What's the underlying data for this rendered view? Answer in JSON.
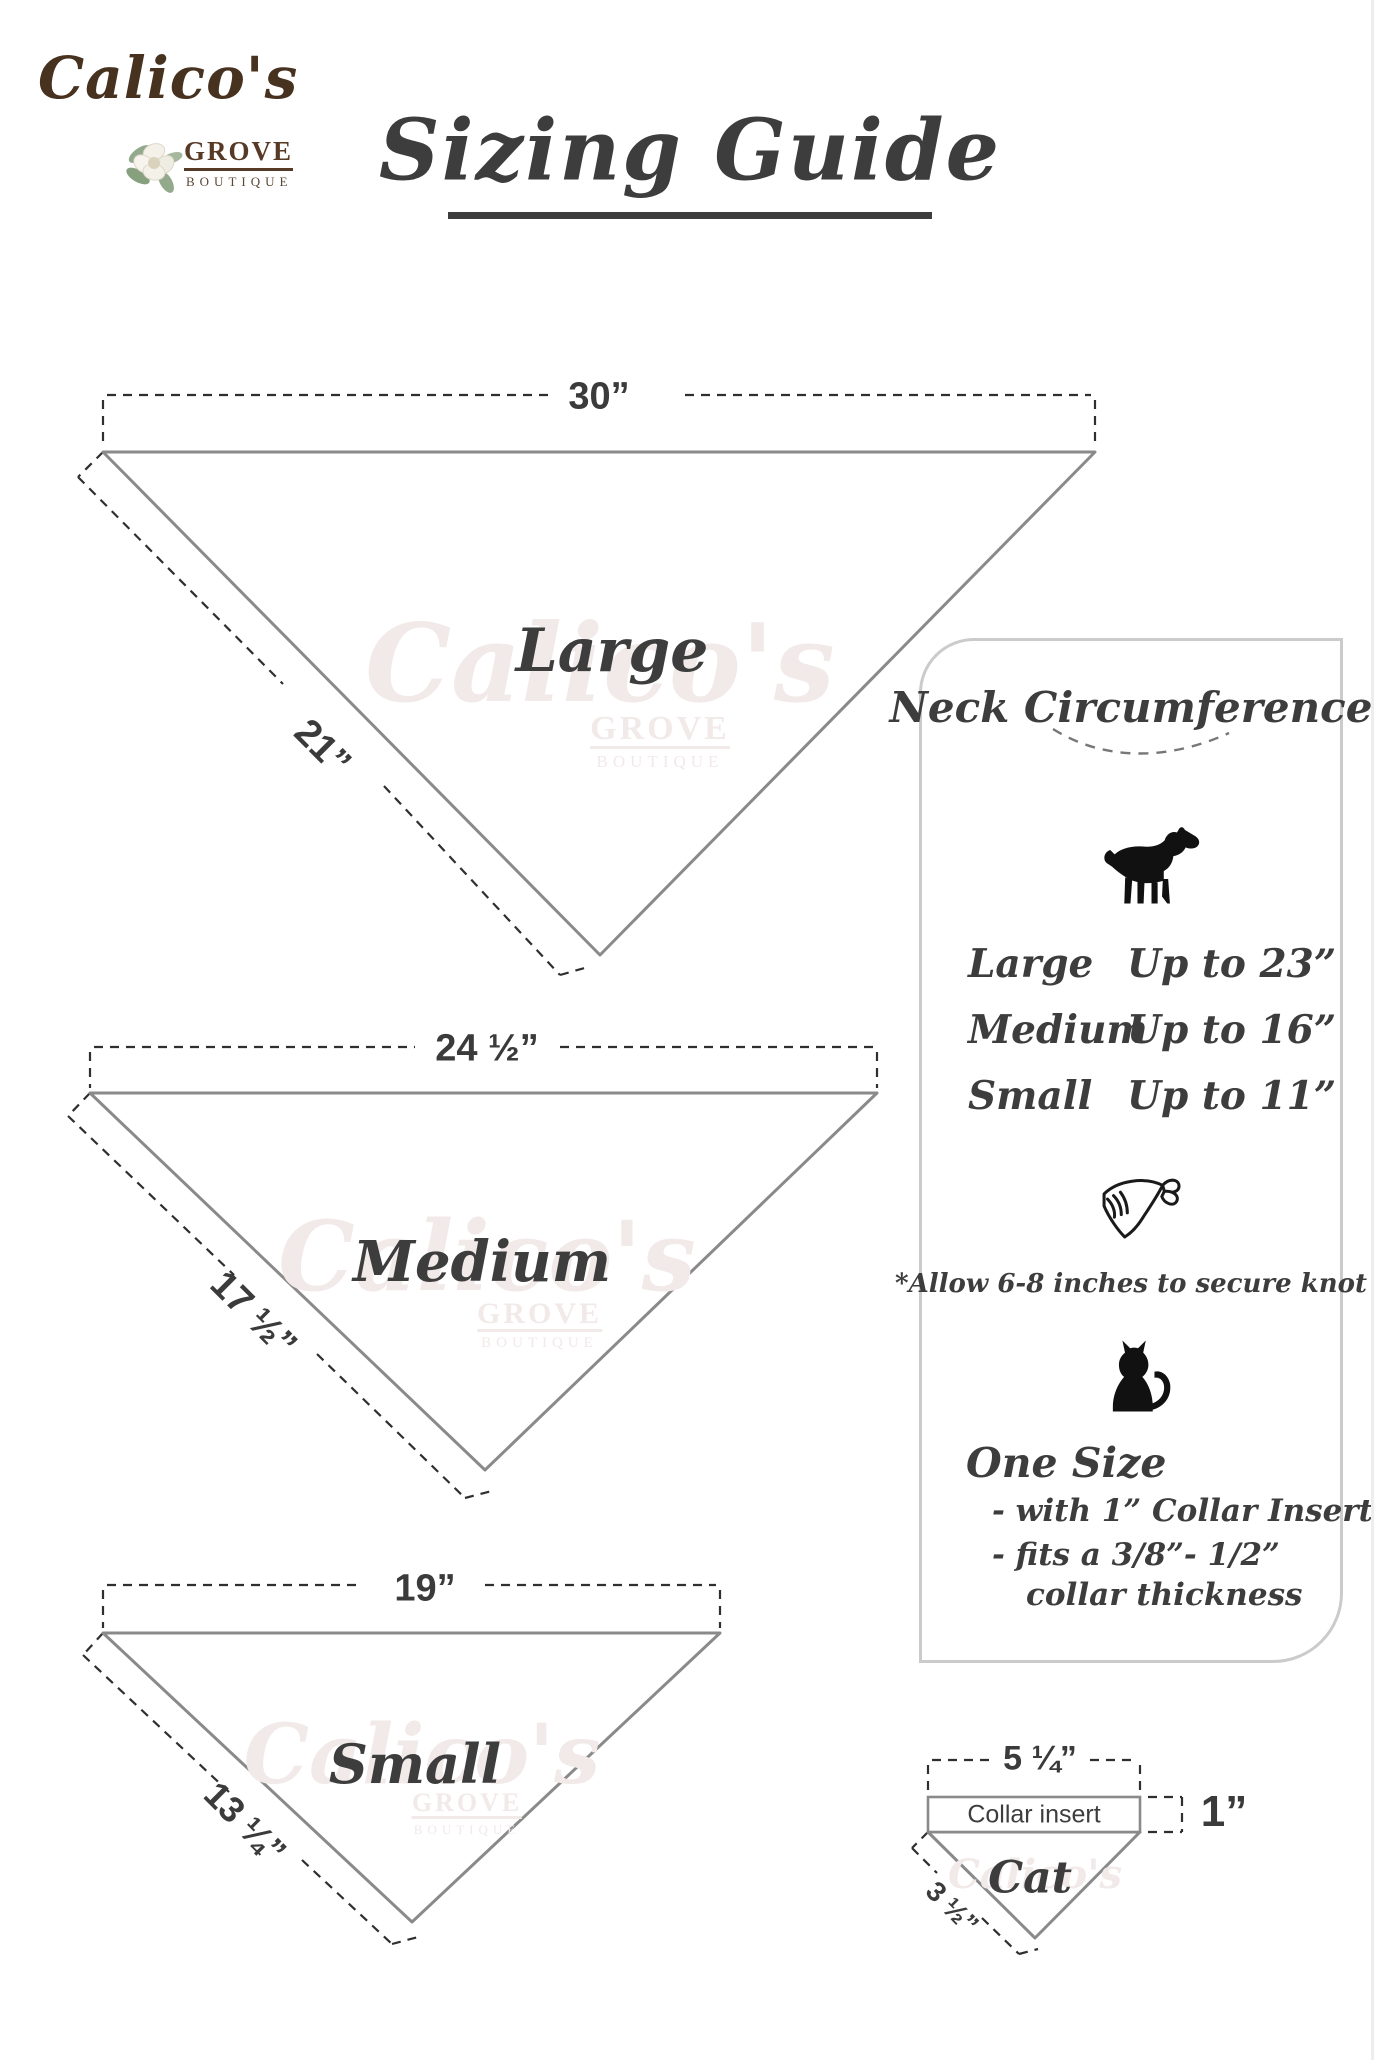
{
  "logo": {
    "name": "Calico's",
    "grove": "GROVE",
    "boutique": "BOUTIQUE"
  },
  "title": "Sizing Guide",
  "watermark": {
    "name": "Calico's",
    "grove": "GROVE",
    "boutique": "BOUTIQUE"
  },
  "bandanas": {
    "large": {
      "label": "Large",
      "top_width": "30”",
      "side_length": "21”"
    },
    "medium": {
      "label": "Medium",
      "top_width": "24 ½”",
      "side_length": "17 ½”"
    },
    "small": {
      "label": "Small",
      "top_width": "19”",
      "side_length": "13 ¼”"
    }
  },
  "panel": {
    "title": "Neck Circumference",
    "rows": [
      {
        "size": "Large",
        "value": "Up to 23”"
      },
      {
        "size": "Medium",
        "value": "Up to 16”"
      },
      {
        "size": "Small",
        "value": "Up to 11”"
      }
    ],
    "knot_note": "*Allow 6-8 inches to secure knot",
    "one_size": "One Size",
    "detail_1": "- with 1” Collar Insert",
    "detail_2": "- fits a 3/8”- 1/2”",
    "detail_3": "collar thickness"
  },
  "cat_diagram": {
    "top_width": "5 ¼”",
    "collar_label": "Collar insert",
    "collar_height": "1”",
    "side_length": "3 ½”",
    "label": "Cat"
  },
  "colors": {
    "ink": "#3d3d3d",
    "triangle_stroke": "#8a8a8a",
    "dash_line": "#2f2f2f",
    "logo_brown": "#47311f",
    "panel_border": "#cbcbcb",
    "watermark": "#f2e9e9",
    "icon_black": "#111111"
  }
}
